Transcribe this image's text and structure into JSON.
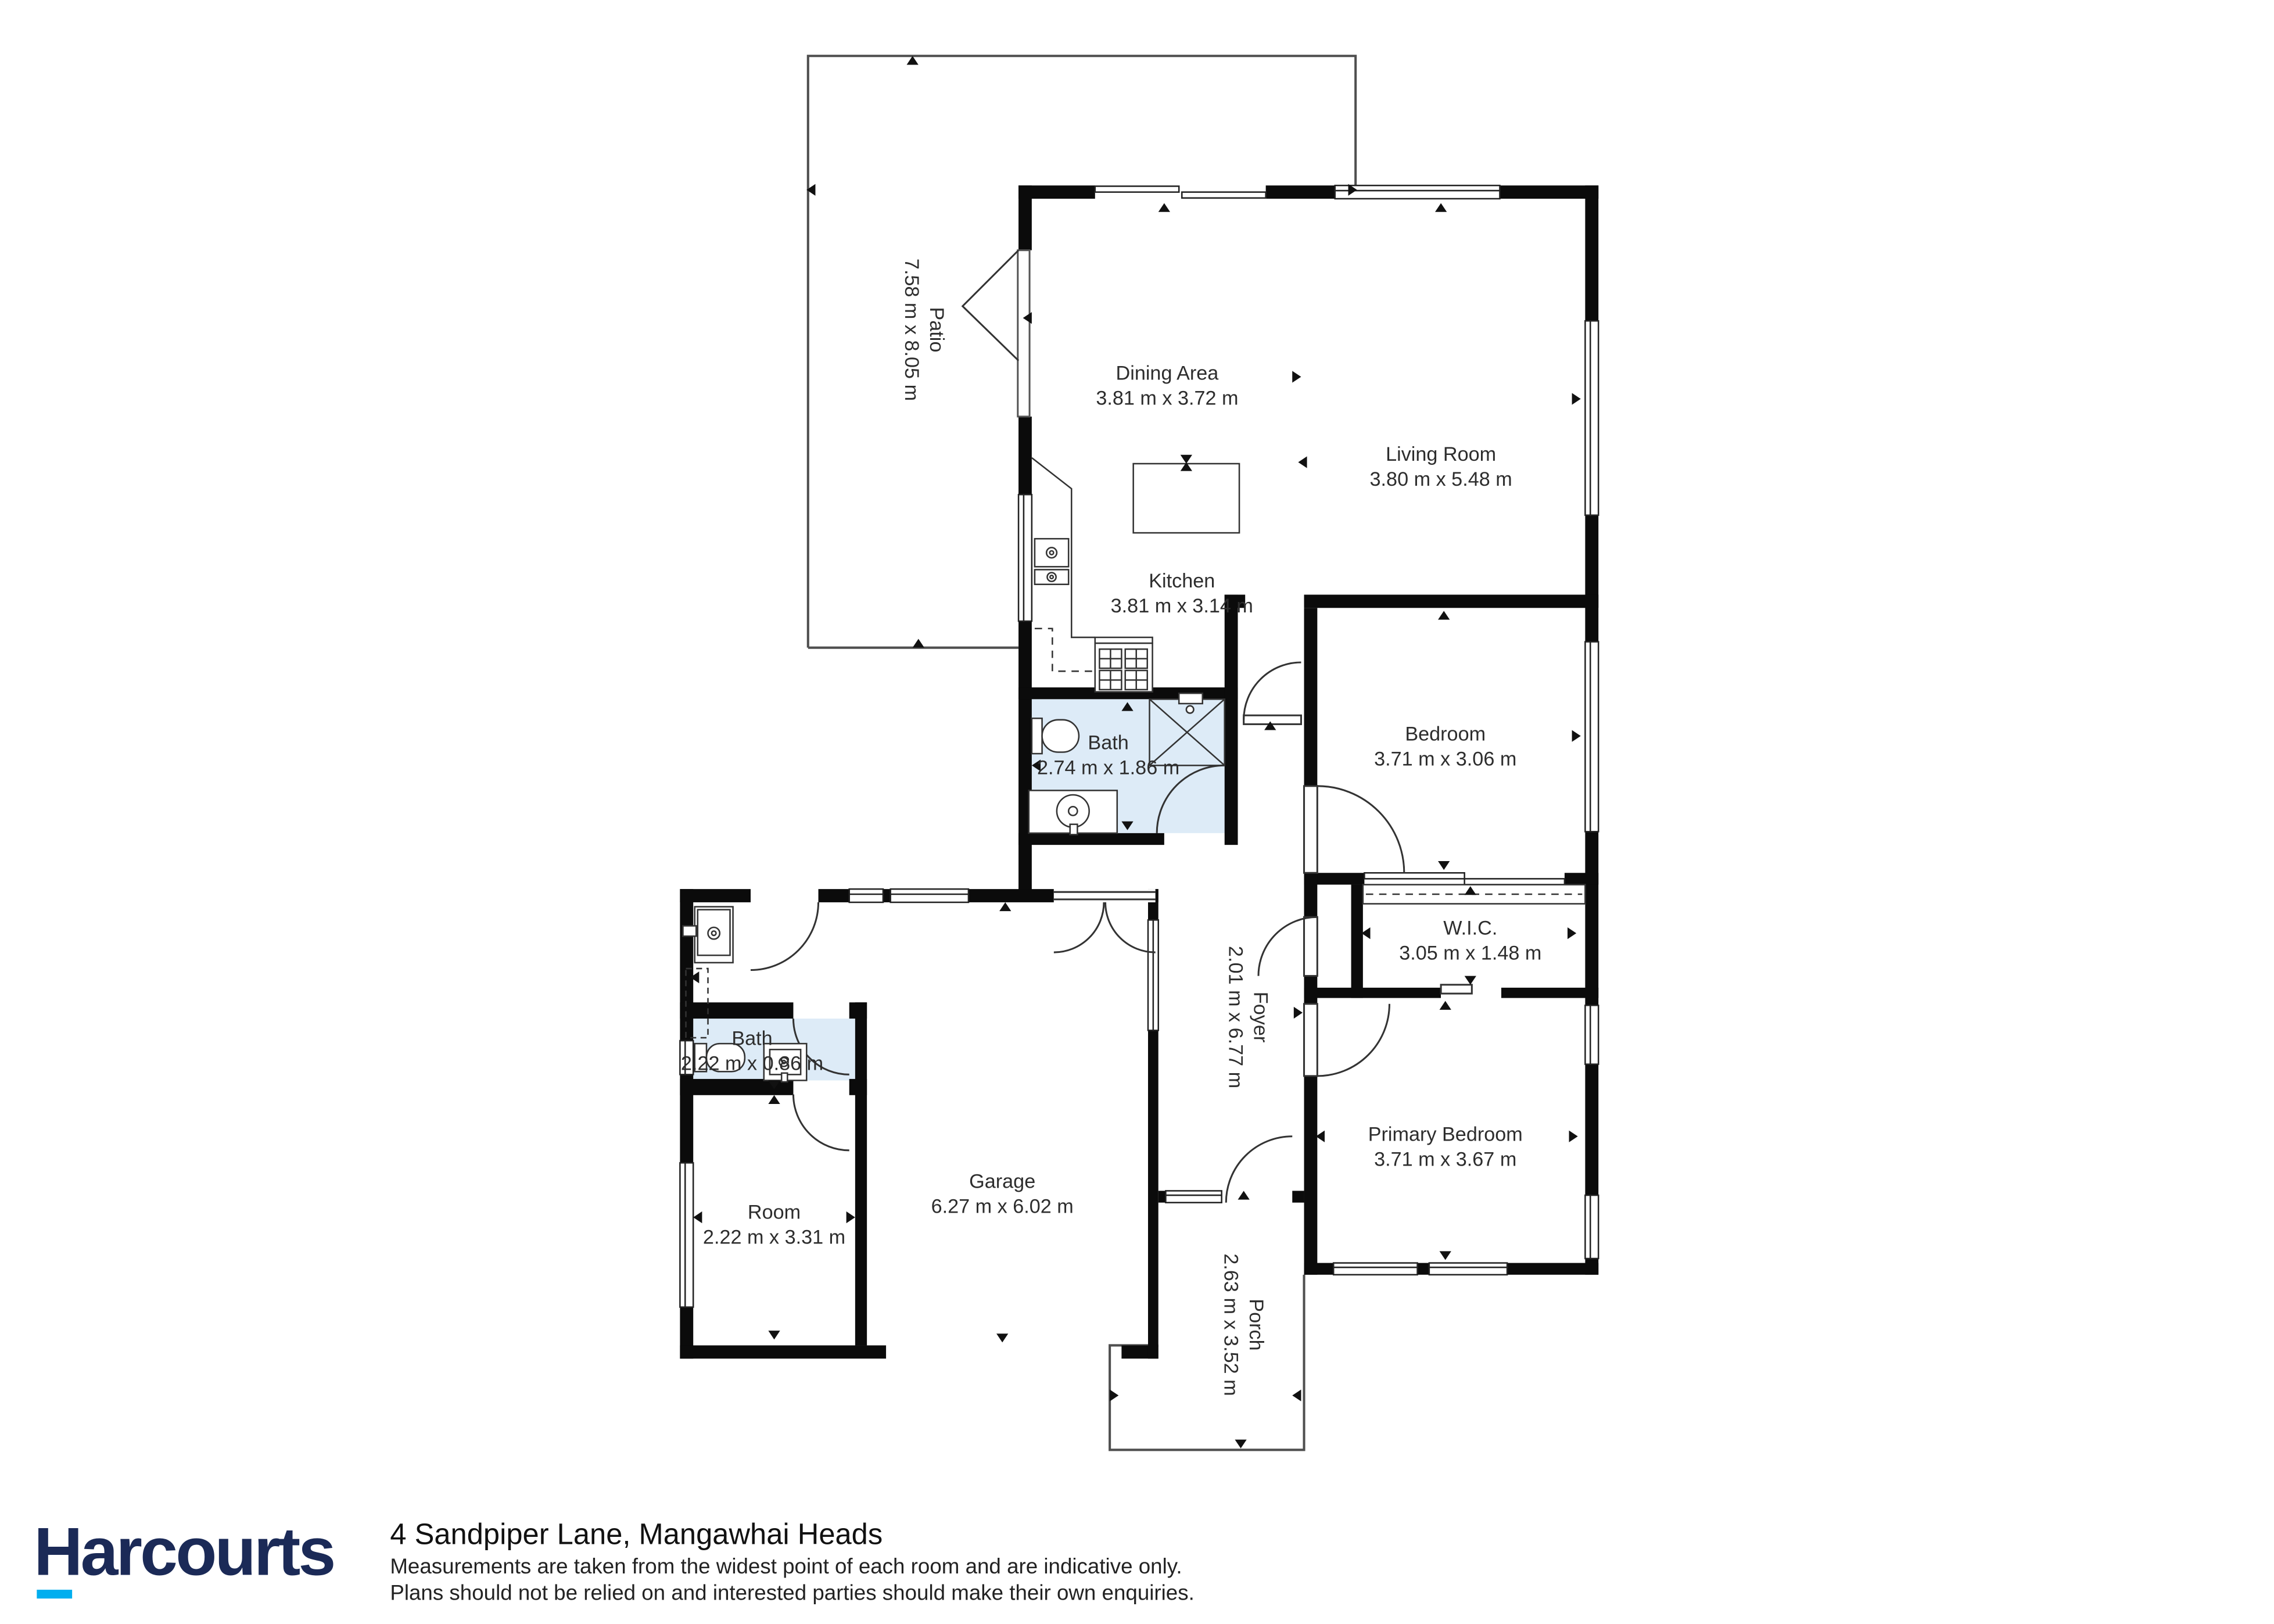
{
  "plan": {
    "rooms": [
      {
        "id": "dining",
        "name": "Dining Area",
        "dims": "3.81 m x 3.72 m"
      },
      {
        "id": "living",
        "name": "Living Room",
        "dims": "3.80 m x 5.48 m"
      },
      {
        "id": "kitchen",
        "name": "Kitchen",
        "dims": "3.81 m x 3.14 m"
      },
      {
        "id": "bath",
        "name": "Bath",
        "dims": "2.74 m x 1.86 m"
      },
      {
        "id": "bedroom",
        "name": "Bedroom",
        "dims": "3.71 m x 3.06 m"
      },
      {
        "id": "wic",
        "name": "W.I.C.",
        "dims": "3.05 m x 1.48 m"
      },
      {
        "id": "primary-bedroom",
        "name": "Primary Bedroom",
        "dims": "3.71 m x 3.67 m"
      },
      {
        "id": "garage",
        "name": "Garage",
        "dims": "6.27 m x 6.02 m"
      },
      {
        "id": "bath-2",
        "name": "Bath",
        "dims": "2.22 m x 0.86 m"
      },
      {
        "id": "room",
        "name": "Room",
        "dims": "2.22 m x 3.31 m"
      },
      {
        "id": "patio",
        "name": "Patio",
        "dims": "7.58 m x 8.05 m"
      },
      {
        "id": "foyer",
        "name": "Foyer",
        "dims": "2.01 m x 6.77 m"
      },
      {
        "id": "porch",
        "name": "Porch",
        "dims": "2.63 m x 3.52 m"
      }
    ]
  },
  "footer": {
    "brand": "Harcourts",
    "address": "4 Sandpiper Lane, Mangawhai Heads",
    "disclaimer_line1": "Measurements are taken from the widest point of each room and are indicative only.",
    "disclaimer_line2": "Plans should not be relied on and interested parties should make their own enquiries."
  },
  "colors": {
    "bath_highlight": "#ddebf7",
    "wall": "#0b0b0b",
    "brand_navy": "#1b2a57",
    "brand_cyan": "#00aeef"
  }
}
